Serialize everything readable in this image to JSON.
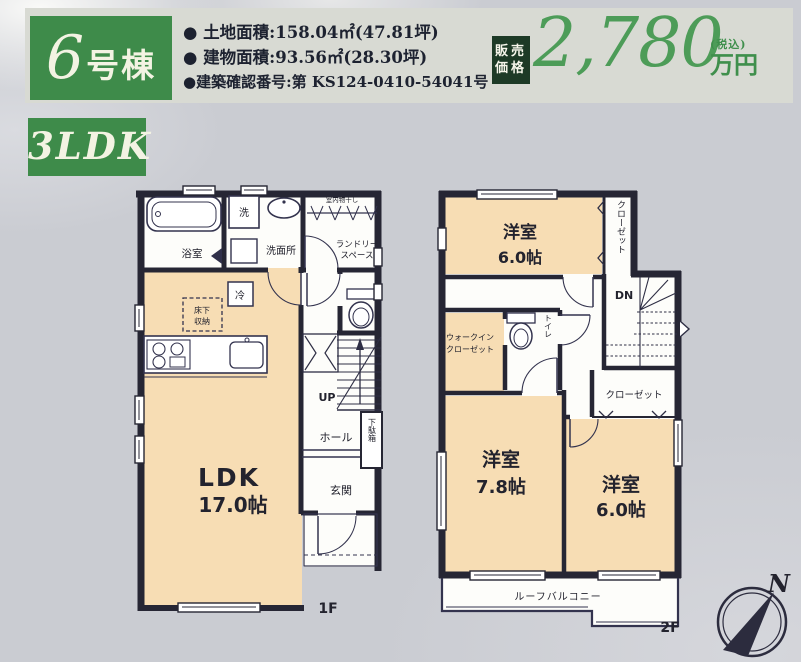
{
  "colors": {
    "badge_green": "#3e8b4a",
    "price_green": "#4d9c58",
    "price_badge_bg": "#1d3a26",
    "wall": "#262634",
    "room_fill": "#f7ddb4",
    "paper_bg": "#caccd2",
    "header_band": "#d8dad3",
    "text_dark": "#1d2230"
  },
  "header": {
    "unit_number": "6",
    "unit_suffix": "号棟",
    "specs": [
      "● 土地面積:158.04㎡(47.81坪)",
      "● 建物面積:93.56㎡(28.30坪)",
      "●建築確認番号:第 KS124-0410-54041号"
    ],
    "price_badge_line1": "販売",
    "price_badge_line2": "価格",
    "price_value": "2,780",
    "price_tax": "(税込)",
    "price_unit": "万円"
  },
  "layout_badge": "3LDK",
  "floor1": {
    "label": "1F",
    "bath": "浴室",
    "washer": "洗",
    "washroom": "洗面所",
    "drying": "室内物干し",
    "laundry1": "ランドリー",
    "laundry2": "スペース",
    "fridge": "冷",
    "underfloor1": "床下",
    "underfloor2": "収納",
    "ldk": "LDK",
    "ldk_size": "17.0帖",
    "up": "UP",
    "hall": "ホール",
    "shoebox": "下駄箱",
    "entrance": "玄関"
  },
  "floor2": {
    "label": "2F",
    "room_a": "洋室",
    "room_a_size": "6.0帖",
    "closet_a": "クローゼット",
    "dn": "DN",
    "wic1": "ウォークイン",
    "wic2": "クローゼット",
    "toilet": "トイレ",
    "closet_b": "クローゼット",
    "room_b": "洋室",
    "room_b_size": "7.8帖",
    "room_c": "洋室",
    "room_c_size": "6.0帖",
    "balcony": "ルーフバルコニー"
  },
  "compass": {
    "north": "N"
  }
}
